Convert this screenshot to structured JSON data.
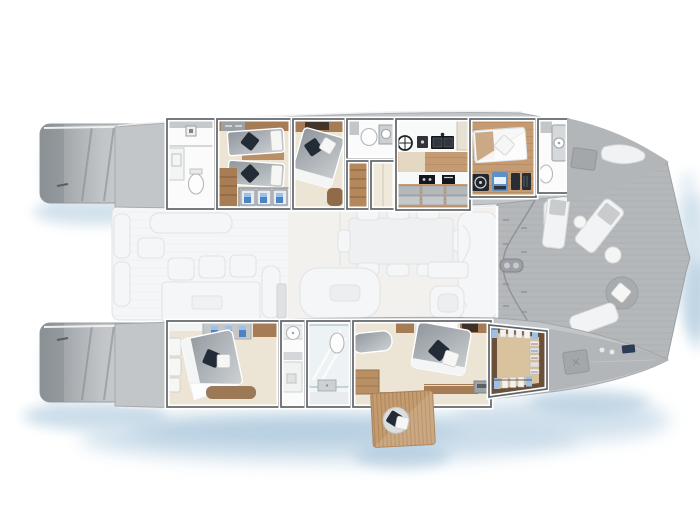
{
  "plan": {
    "subject": "Catamaran yacht top-view accommodation and deck plan",
    "orientation": "bow-right",
    "port_hull_rooms": [
      "aft-bathroom",
      "twin-guest-cabin",
      "vip-guest-cabin",
      "mid-bathroom",
      "companionway-stairs",
      "galley",
      "forward-cabin",
      "forward-bathroom"
    ],
    "starboard_hull_rooms": [
      "aft-guest-cabin",
      "bathroom",
      "shower-room",
      "owner-suite",
      "walk-in-closet"
    ],
    "main_deck_areas": [
      "aft-cockpit-dining",
      "salon-dining-table",
      "helm-lounge",
      "mast"
    ],
    "foredeck_furniture": [
      "sun-lounger",
      "sun-lounger",
      "side-table",
      "side-table",
      "round-pouf",
      "sun-pad",
      "deck-hatch",
      "windlass",
      "tender"
    ],
    "exterior_features": [
      "port-swim-platform",
      "starboard-swim-platform",
      "fold-down-terrace",
      "terrace-stool"
    ]
  },
  "colors": {
    "page_bg": "#ffffff",
    "hull": "#c3c6c9",
    "hull_dark": "#b2b6b9",
    "hull_light": "#d6d9db",
    "plat_dark": "#8f9499",
    "hull_edge": "#9b9fa2",
    "deck": "#b5b8bb",
    "deck_line": "#a4a7aa",
    "wall": "#5f6468",
    "room_beige": "#ece4d4",
    "room_white": "#fafbfa",
    "wood": "#a57c56",
    "wood_dark": "#8a6240",
    "wood_floor": "#c49b72",
    "wood_floor_line": "#ad8257",
    "bed_1": "#8f969c",
    "bed_2": "#ced2d5",
    "mattress": "#f4f5f5",
    "pillow_navy": "#232b36",
    "pillow_white": "#f6f6f4",
    "appliance": "#14171b",
    "clothes_blue": "#4f82c4",
    "clothes_blue_light": "#9cc0e8",
    "closet_wood": "#6b4f38",
    "closet_floor": "#d9c29e",
    "water_1": "#c7daE8",
    "water_2": "#a4c2d8",
    "faded_fill": "#f5f6f7",
    "faded_stroke": "#e0e3e5",
    "steel": "#9ca1a5"
  }
}
